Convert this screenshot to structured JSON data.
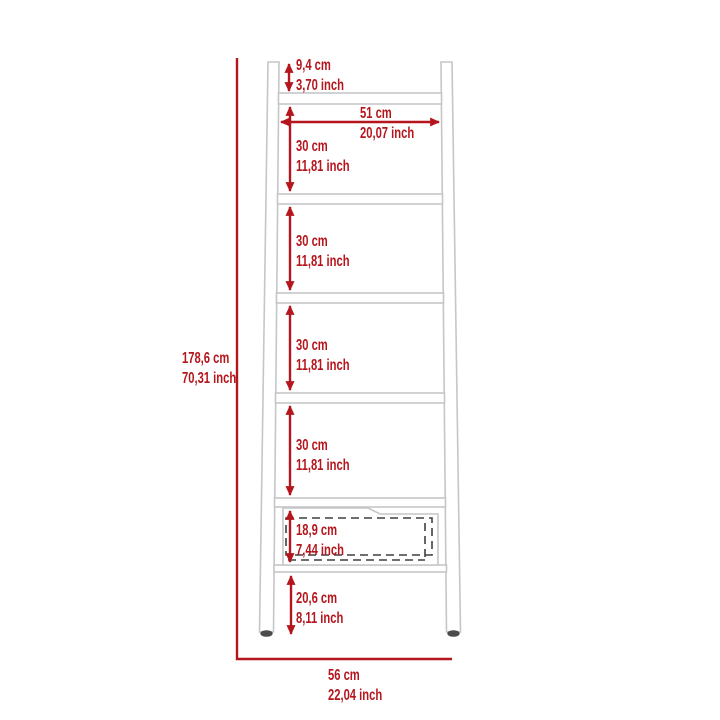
{
  "diagram": {
    "colors": {
      "dimension_red": "#b5151c",
      "furniture_outline_gray": "#c5c6c8",
      "drawer_dashed_dark": "#3f4040",
      "foot_dark": "#4c4c4c",
      "background": "#ffffff"
    }
  },
  "dimensions": {
    "total_height": {
      "metric": "178,6 cm",
      "imperial": "70,31 inch"
    },
    "total_width": {
      "metric": "56 cm",
      "imperial": "22,04 inch"
    },
    "top_gap": {
      "metric": "9,4 cm",
      "imperial": "3,70 inch"
    },
    "shelf_width": {
      "metric": "51 cm",
      "imperial": "20,07 inch"
    },
    "section_1": {
      "metric": "30 cm",
      "imperial": "11,81 inch"
    },
    "section_2": {
      "metric": "30 cm",
      "imperial": "11,81 inch"
    },
    "section_3": {
      "metric": "30 cm",
      "imperial": "11,81 inch"
    },
    "section_4": {
      "metric": "30 cm",
      "imperial": "11,81 inch"
    },
    "drawer_height": {
      "metric": "18,9 cm",
      "imperial": "7,44 inch"
    },
    "bottom_gap": {
      "metric": "20,6 cm",
      "imperial": "8,11 inch"
    }
  }
}
